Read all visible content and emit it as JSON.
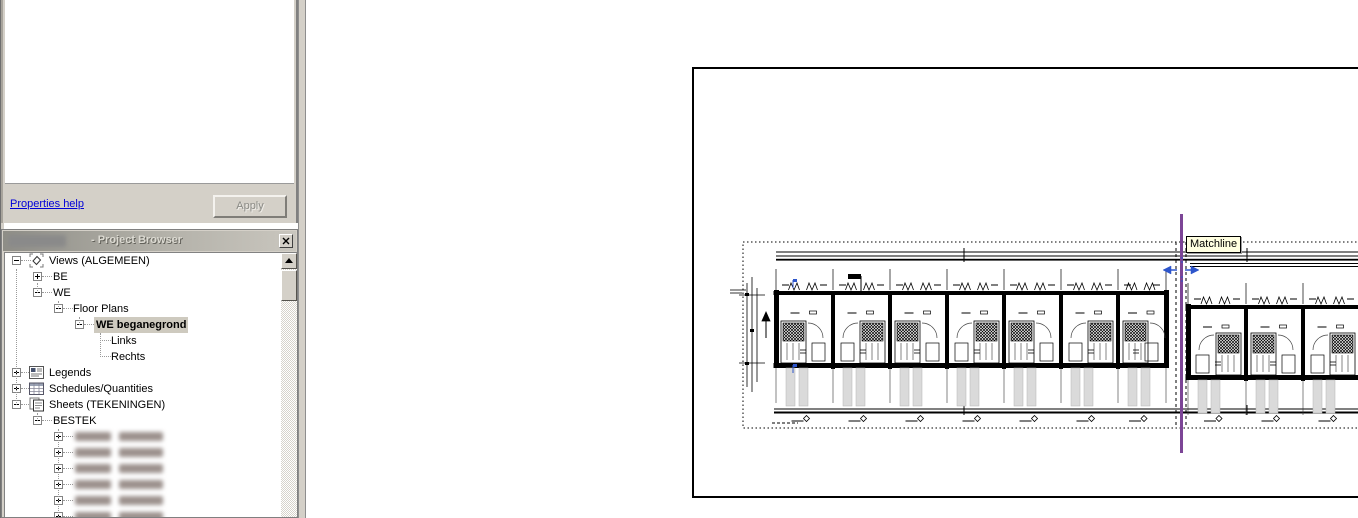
{
  "properties_panel": {
    "help_link": "Properties help",
    "apply_button": "Apply"
  },
  "project_browser": {
    "title": "- Project Browser",
    "close_button": "x",
    "tree": [
      {
        "label": "Views (ALGEMEEN)",
        "depth": 0,
        "expander": "minus",
        "icon": "views-icon"
      },
      {
        "label": "BE",
        "depth": 1,
        "expander": "plus"
      },
      {
        "label": "WE",
        "depth": 1,
        "expander": "minus"
      },
      {
        "label": "Floor Plans",
        "depth": 2,
        "expander": "minus"
      },
      {
        "label": "WE beganegrond",
        "depth": 3,
        "expander": "minus",
        "selected": true
      },
      {
        "label": "Links",
        "depth": 4
      },
      {
        "label": "Rechts",
        "depth": 4
      },
      {
        "label": "Legends",
        "depth": 0,
        "expander": "plus",
        "icon": "legends-icon"
      },
      {
        "label": "Schedules/Quantities",
        "depth": 0,
        "expander": "plus",
        "icon": "schedules-icon"
      },
      {
        "label": "Sheets (TEKENINGEN)",
        "depth": 0,
        "expander": "minus",
        "icon": "sheets-icon"
      },
      {
        "label": "BESTEK",
        "depth": 1,
        "expander": "minus"
      },
      {
        "redacted": true,
        "depth": 2,
        "expander": "plus"
      },
      {
        "redacted": true,
        "depth": 2,
        "expander": "plus"
      },
      {
        "redacted": true,
        "depth": 2,
        "expander": "plus"
      },
      {
        "redacted": true,
        "depth": 2,
        "expander": "plus"
      },
      {
        "redacted": true,
        "depth": 2,
        "expander": "plus"
      },
      {
        "redacted": true,
        "depth": 2,
        "expander": "plus"
      }
    ]
  },
  "drawing": {
    "tooltip": "Matchline",
    "left_block_units": 7,
    "right_block_units": 6,
    "colors": {
      "matchline_purple": "#7c4596",
      "handle_blue": "#2d55cb",
      "line_black": "#000000",
      "strip_gray": "#dadada",
      "tooltip_bg": "#ffffe1",
      "selection_bg": "#cecabf",
      "chrome_gray": "#d4d0c8",
      "link_blue": "#0000d8"
    }
  }
}
